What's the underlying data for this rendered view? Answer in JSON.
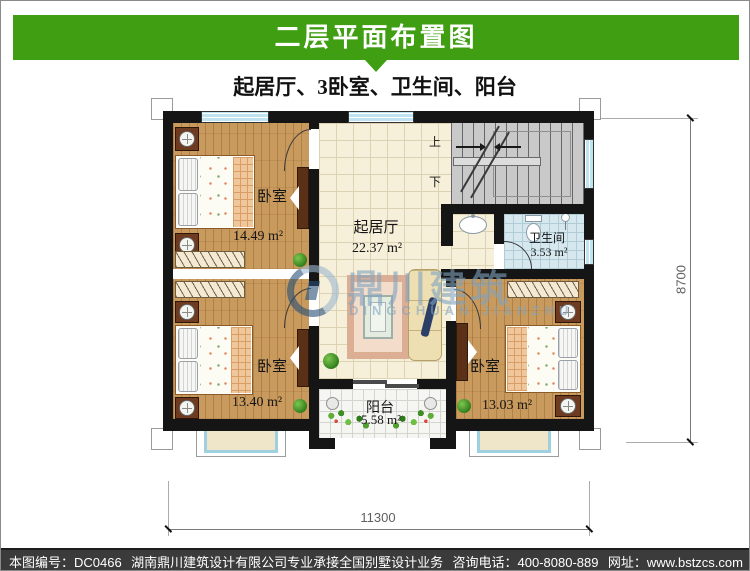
{
  "header": {
    "title": "二层平面布置图",
    "subtitle": "起居厅、3卧室、卫生间、阳台"
  },
  "rooms": {
    "bedroom_tl": {
      "name": "卧室",
      "area": "14.49 m²"
    },
    "bedroom_bl": {
      "name": "卧室",
      "area": "13.40 m²"
    },
    "bedroom_br": {
      "name": "卧室",
      "area": "13.03 m²"
    },
    "living": {
      "name": "起居厅",
      "area": "22.37 m²"
    },
    "bathroom": {
      "name": "卫生间",
      "area": "3.53 m²"
    },
    "balcony": {
      "name": "阳台",
      "area": "5.58 m²"
    }
  },
  "stairs": {
    "up_label": "上",
    "down_label": "下"
  },
  "dimensions": {
    "bottom": "11300",
    "right": "8700"
  },
  "watermark": {
    "cn": "鼎川建筑",
    "en": "DINGCHUAN JIANZHU"
  },
  "footer": {
    "plan_no": "本图编号：DC0466",
    "company": "湖南鼎川建筑设计有限公司专业承接全国别墅设计业务",
    "phone": "咨询电话：400-8080-889",
    "website": "网址：www.bstzcs.com"
  },
  "colors": {
    "banner": "#3f9e11",
    "footer_bg": "#3b3b3b"
  }
}
